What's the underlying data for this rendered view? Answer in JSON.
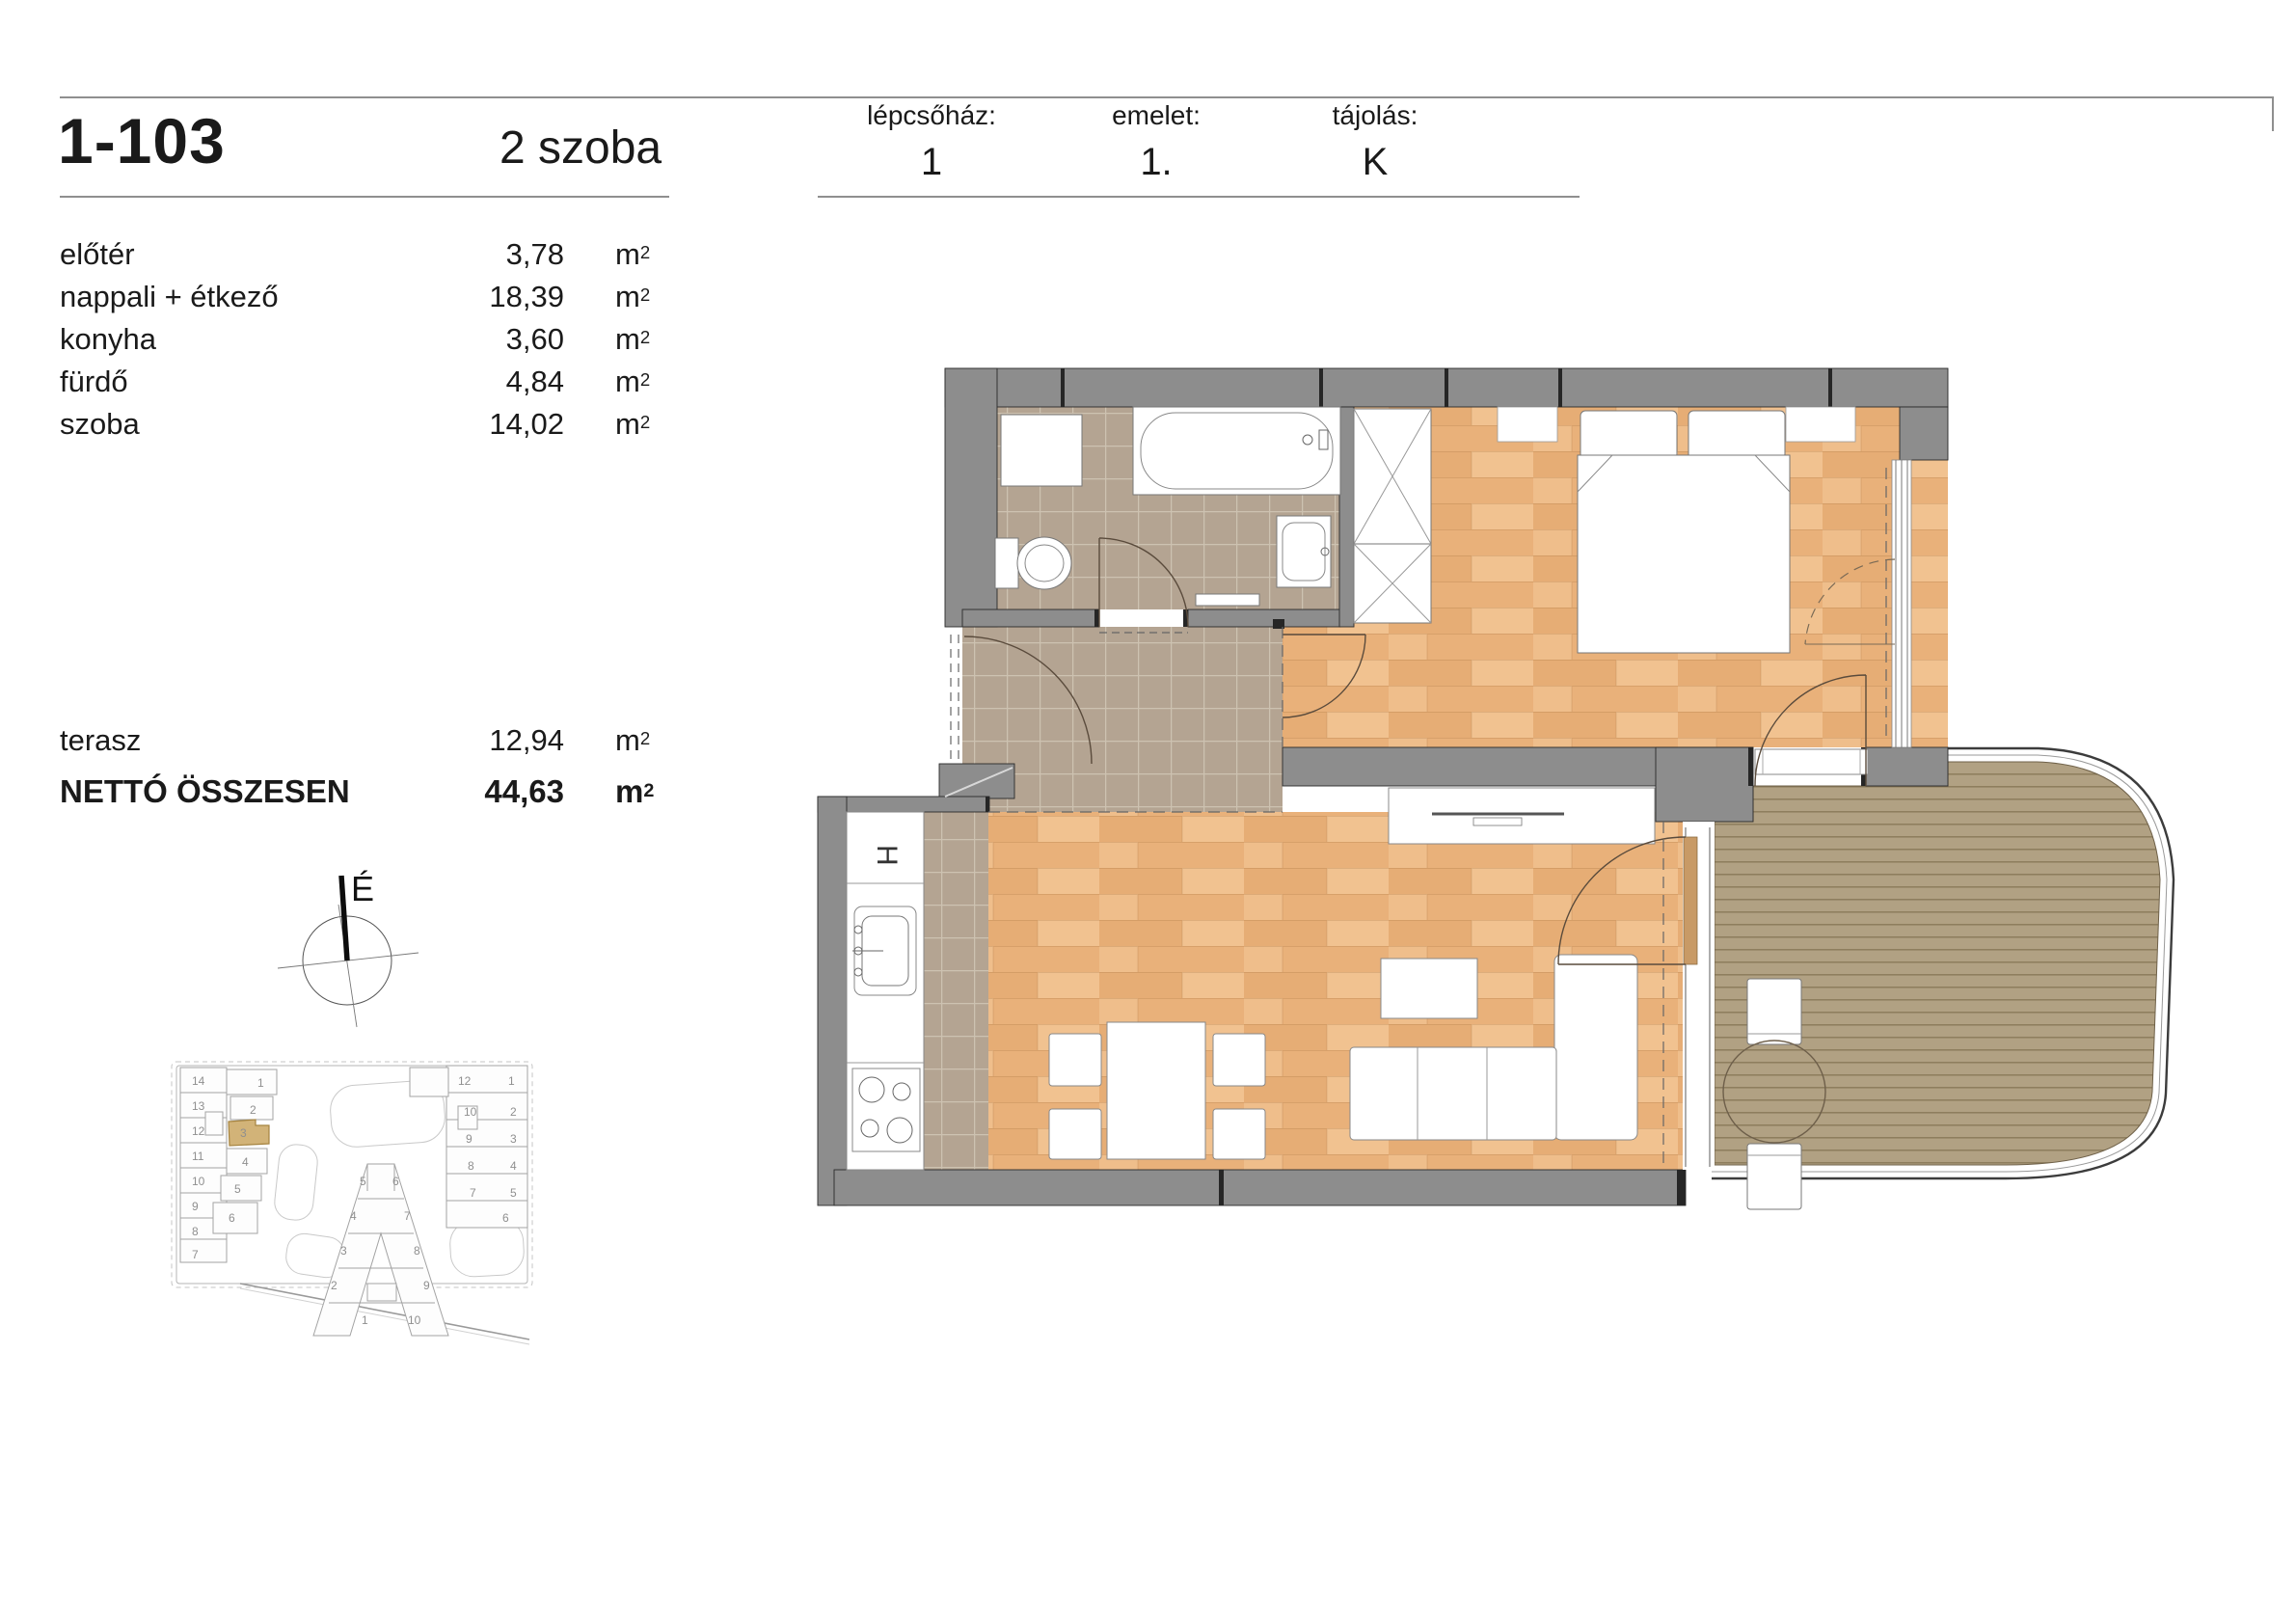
{
  "title": {
    "unit_id": "1-103",
    "room_count": "2 szoba"
  },
  "header": [
    {
      "label": "lépcsőház:",
      "value": "1"
    },
    {
      "label": "emelet:",
      "value": "1."
    },
    {
      "label": "tájolás:",
      "value": "K"
    }
  ],
  "unit": {
    "base": "m",
    "sup": "2"
  },
  "rooms": [
    {
      "name": "előtér",
      "area": "3,78"
    },
    {
      "name": "nappali + étkező",
      "area": "18,39"
    },
    {
      "name": "konyha",
      "area": "3,60"
    },
    {
      "name": "fürdő",
      "area": "4,84"
    },
    {
      "name": "szoba",
      "area": "14,02"
    }
  ],
  "terrace": {
    "name": "terasz",
    "area": "12,94"
  },
  "total": {
    "name": "NETTÓ ÖSSZESEN",
    "area": "44,63"
  },
  "compass": {
    "north_label": "É"
  },
  "fixtures": {
    "fridge_label": "H"
  },
  "minimap": {
    "left_numbers": [
      "14",
      "13",
      "12",
      "11",
      "10",
      "9",
      "8",
      "7"
    ],
    "wing_numbers": [
      "1",
      "2",
      "3",
      "4",
      "5",
      "6"
    ],
    "middle_numbers": [
      "5",
      "6",
      "4",
      "7",
      "3",
      "8",
      "2",
      "9",
      "1",
      "10"
    ],
    "right_numbers": [
      "12",
      "1",
      "10",
      "2",
      "9",
      "3",
      "8",
      "4",
      "7",
      "5",
      "6"
    ],
    "highlight_color": "#d2b378"
  },
  "colors": {
    "wall": "#8d8d8d",
    "wood_floor": "#eab77f",
    "tile_floor": "#b4a492",
    "deck": "#b1a183",
    "highlight": "#d2b378",
    "rule": "#8f8f8f"
  }
}
